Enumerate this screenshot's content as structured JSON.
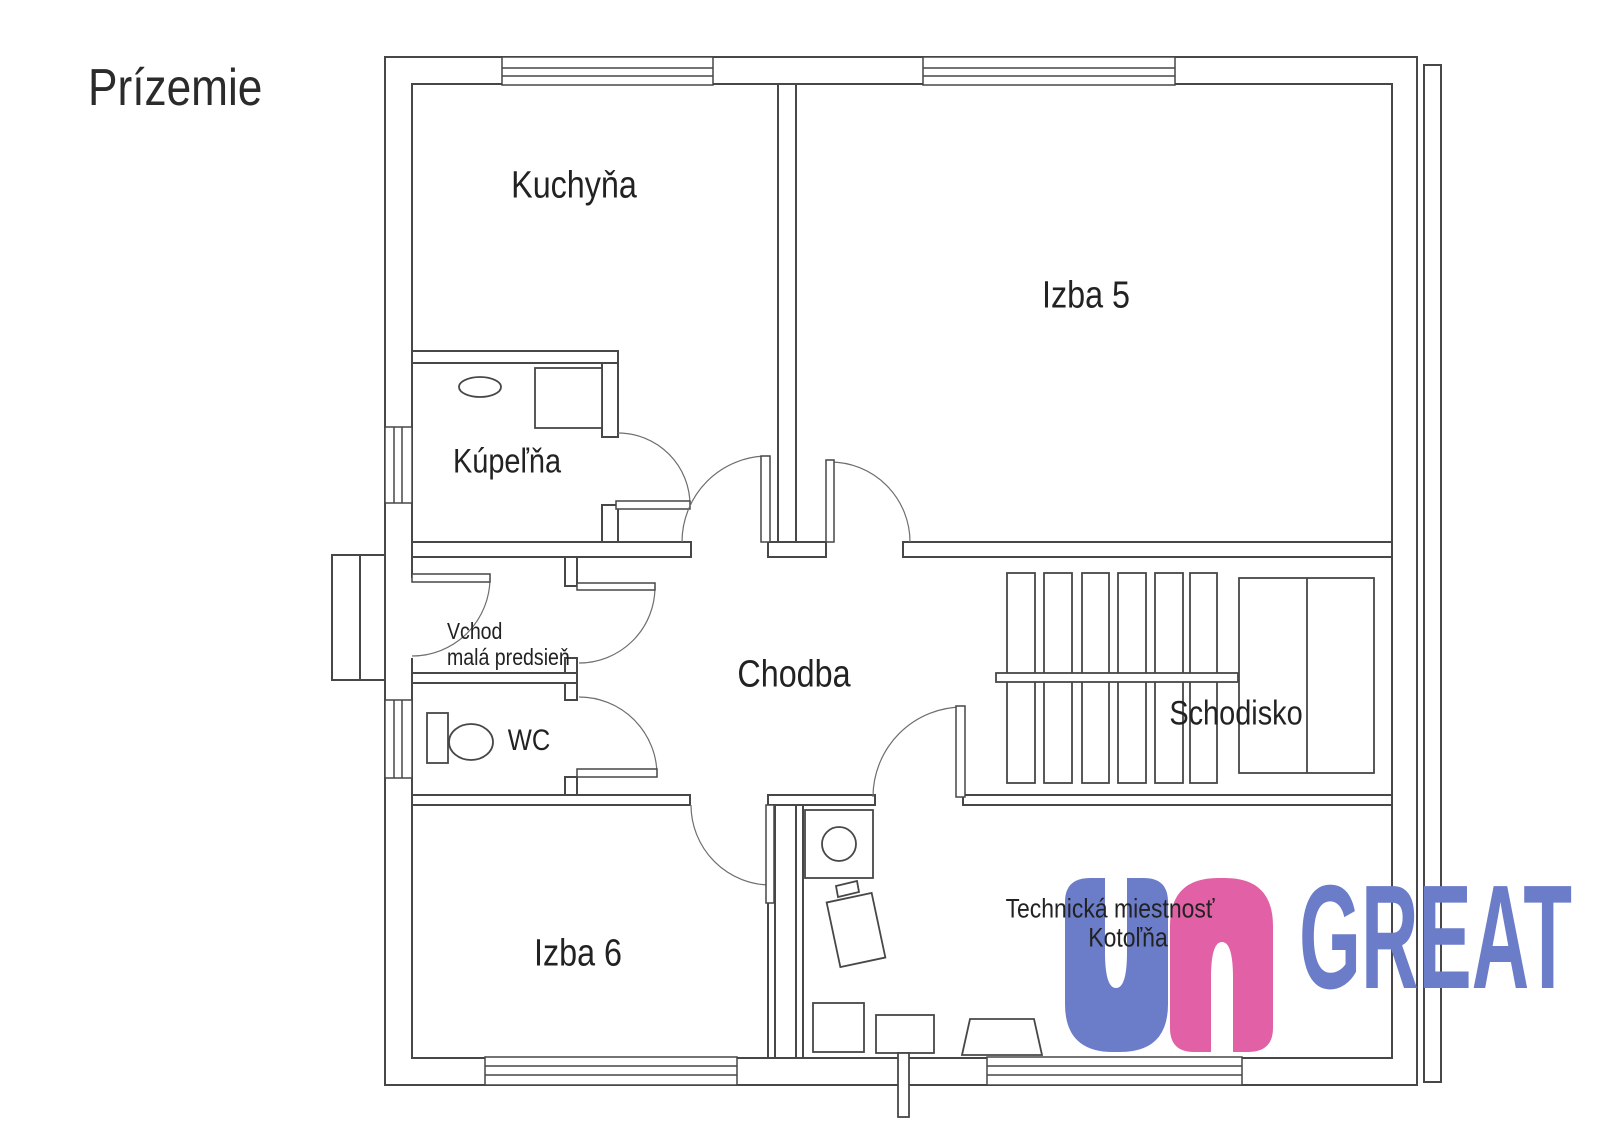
{
  "title": "Prízemie",
  "rooms": {
    "kitchen": "Kuchyňa",
    "room5": "Izba 5",
    "bathroom": "Kúpeľňa",
    "entrance_line1": "Vchod",
    "entrance_line2": "malá predsieň",
    "wc": "WC",
    "hallway": "Chodba",
    "staircase": "Schodisko",
    "room6": "Izba 6",
    "technical_line1": "Technická miestnosť",
    "technical_line2": "Kotoľňa"
  },
  "logo": {
    "text": "GREAT",
    "blue": "#6b7cc9",
    "pink": "#e260a6"
  },
  "colors": {
    "line": "#474747",
    "arc": "#6e6e6e",
    "text": "#222222",
    "background": "#ffffff"
  }
}
